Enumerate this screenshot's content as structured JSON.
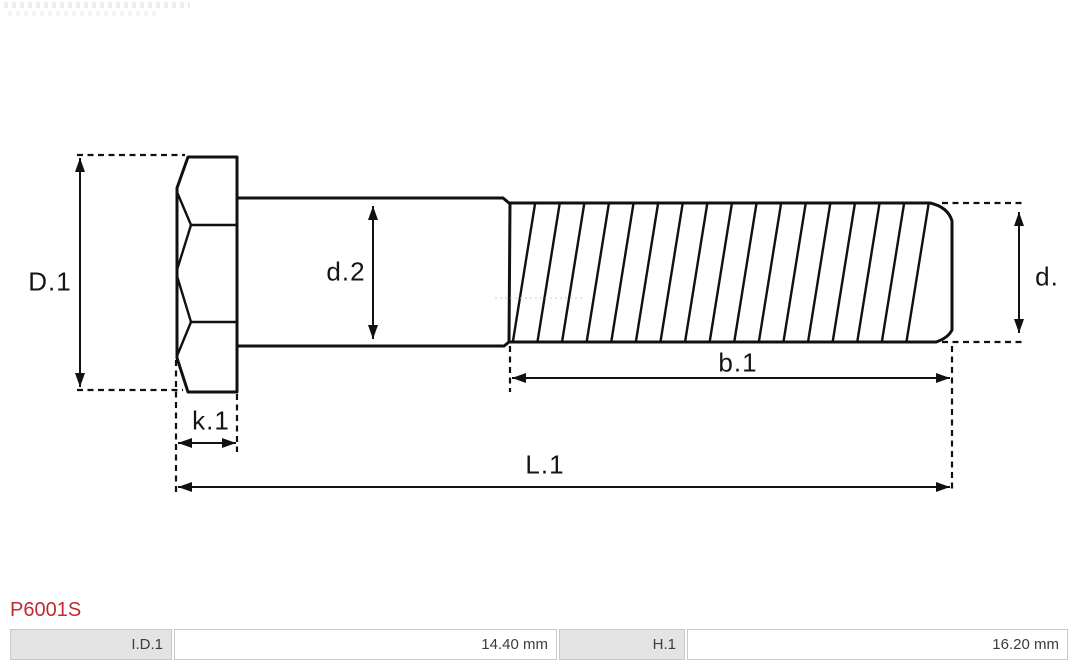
{
  "part_number": "P6001S",
  "drawing": {
    "type": "technical-drawing",
    "subject": "hex-head bolt, side view with thread hatching",
    "dimension_labels": {
      "head_diameter": "D.1",
      "shank_diameter": "d.2",
      "thread_diameter": "d.",
      "head_height": "k.1",
      "thread_length": "b.1",
      "total_length": "L.1"
    }
  },
  "spec_table": {
    "cells": [
      {
        "label": "I.D.1",
        "value": "14.40 mm"
      },
      {
        "label": "H.1",
        "value": "16.20 mm"
      }
    ]
  },
  "colors": {
    "part_number_red": "#bf2c30",
    "table_label_bg": "#e3e3e3",
    "table_border": "#c9c9c9",
    "drawing_line": "#111111"
  }
}
